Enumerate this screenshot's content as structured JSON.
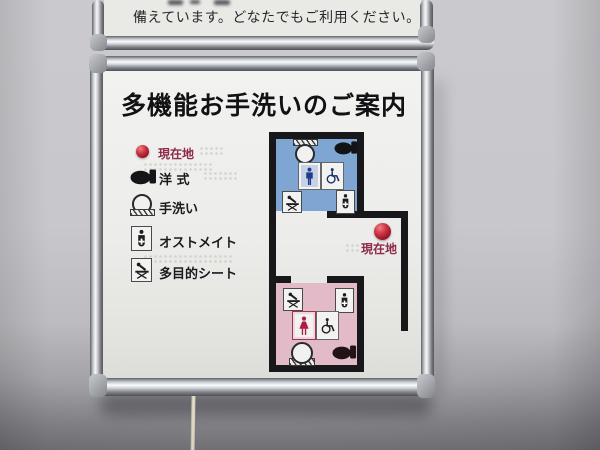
{
  "upper_sign": {
    "text": "備えています。どなたでもご利用ください。"
  },
  "sign": {
    "title": "多機能お手洗いのご案内",
    "legend": [
      {
        "icon": "current-location-dot",
        "label": "現在地"
      },
      {
        "icon": "western-toilet-icon",
        "label": "洋 式"
      },
      {
        "icon": "hand-wash-icon",
        "label": "手洗い"
      },
      {
        "icon": "ostomate-icon",
        "label": "オストメイト"
      },
      {
        "icon": "multipurpose-seat-icon",
        "label": "多目的シート"
      }
    ],
    "map": {
      "current_location_label": "現在地",
      "rooms": [
        {
          "id": "upper-room",
          "fill": "#7fa6d2",
          "icons": [
            "hand-wash",
            "western-toilet",
            "man",
            "wheelchair",
            "multipurpose-seat",
            "ostomate"
          ]
        },
        {
          "id": "lower-room",
          "fill": "#e3bac7",
          "icons": [
            "multipurpose-seat",
            "ostomate",
            "woman",
            "wheelchair",
            "hand-wash",
            "western-toilet"
          ]
        }
      ]
    },
    "colors": {
      "current_location_red": "#a5182b",
      "location_label_red": "#8e2b47",
      "upper_room_blue": "#7fa6d2",
      "lower_room_pink": "#e3bac7",
      "wall_black": "#18181a",
      "man_figure": "#1e3c8c",
      "woman_figure": "#b01c45"
    }
  }
}
